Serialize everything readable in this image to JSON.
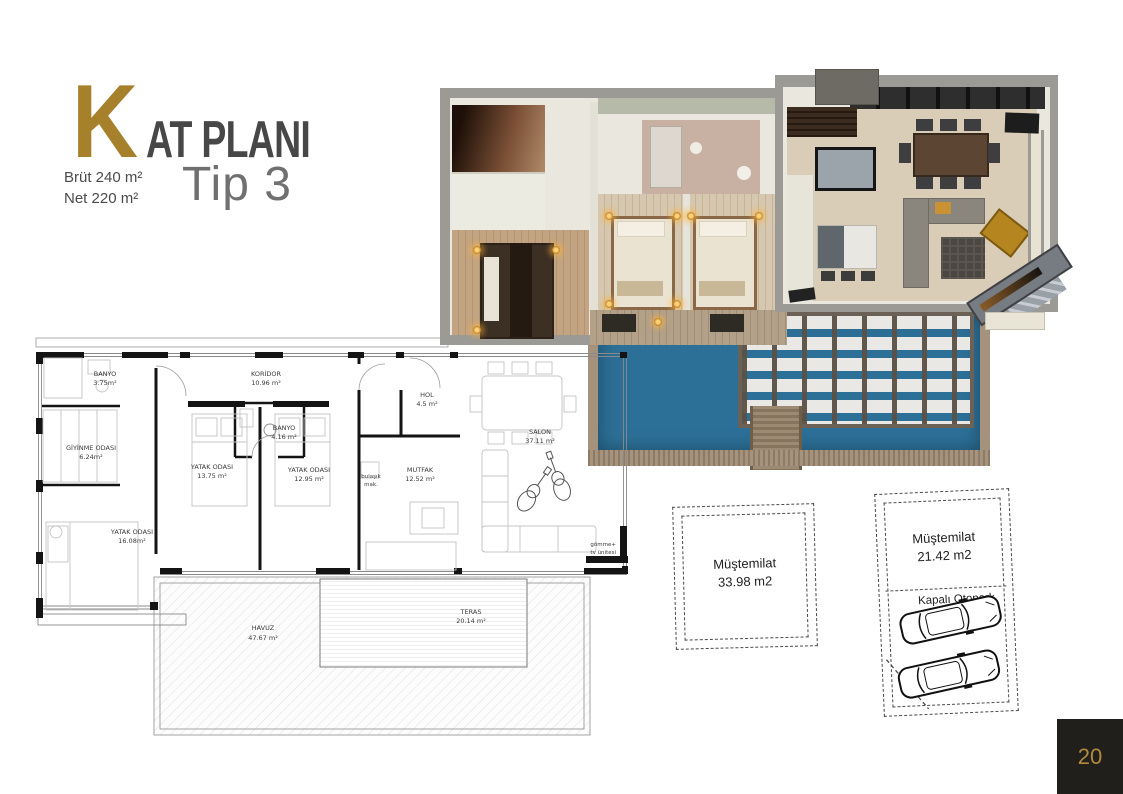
{
  "header": {
    "k": "K",
    "rest": "AT PLANI",
    "brut": "Brüt 240 m²",
    "net": "Net  220 m²",
    "type": "Tip 3"
  },
  "plan2d": {
    "rooms": [
      {
        "name": "BANYO",
        "area": "3.75m²"
      },
      {
        "name": "GİYİNME ODASI",
        "area": "6.24m²"
      },
      {
        "name": "YATAK ODASI",
        "area": "16.08m²"
      },
      {
        "name": "KORİDOR",
        "area": "10.96 m²"
      },
      {
        "name": "YATAK ODASI",
        "area": "13.75 m²"
      },
      {
        "name": "BANYO",
        "area": "4.16 m²"
      },
      {
        "name": "YATAK ODASI",
        "area": "12.95 m²"
      },
      {
        "name": "HOL",
        "area": "4.5 m²"
      },
      {
        "name": "MUTFAK",
        "area": "12.52 m²"
      },
      {
        "name": "SALON",
        "area": "37.11 m²"
      },
      {
        "name": "TERAS",
        "area": "20.14 m²"
      },
      {
        "name": "HAVUZ",
        "area": "47.67 m²"
      }
    ],
    "notes": {
      "dishwasher1": "bulaşık",
      "dishwasher2": "mak.",
      "tv1": "gömme+",
      "tv2": "tv ünitesi"
    }
  },
  "annexes": [
    {
      "name": "Müştemilat",
      "area": "33.98 m2"
    },
    {
      "name": "Müştemilat",
      "area": "21.42 m2",
      "parking": "Kapalı Otopark"
    }
  ],
  "page": {
    "number": "20"
  },
  "colors": {
    "gold": "#A7802C",
    "title_gray": "#474747",
    "pool_blue": "#2D7097",
    "badge_bg": "#211F1C",
    "badge_text": "#B28A3E"
  }
}
